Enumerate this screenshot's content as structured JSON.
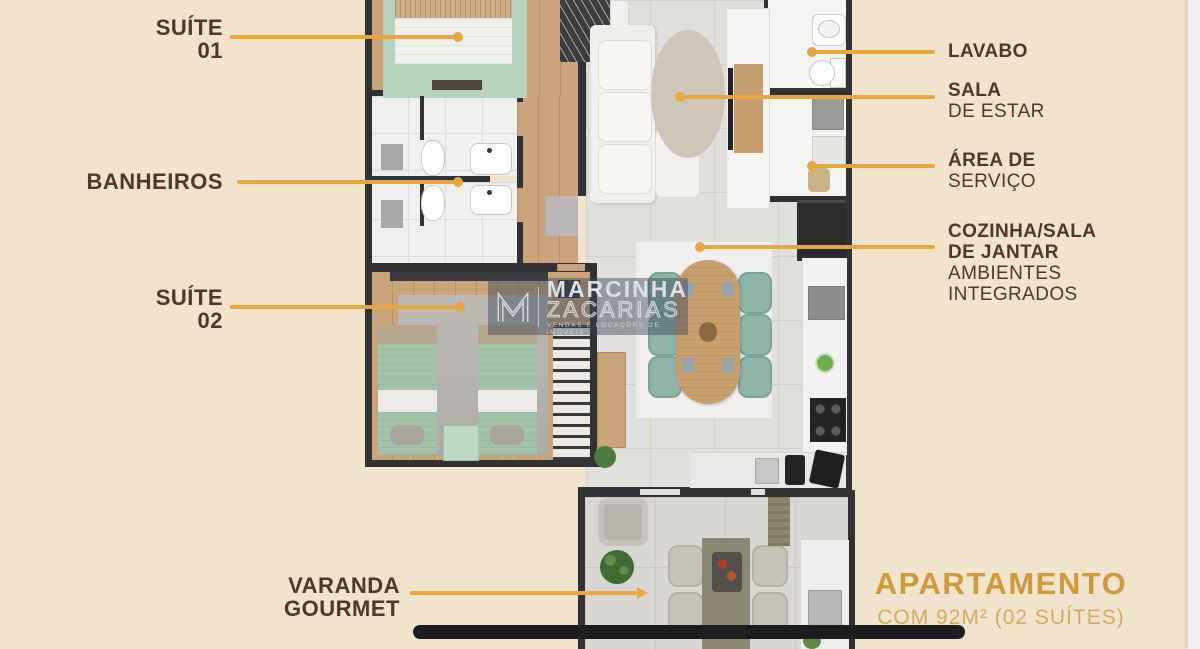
{
  "page": {
    "background": "#f2e3cc",
    "right_edge_strip": "#edeff2"
  },
  "palette": {
    "accent_gold": "#e8a63e",
    "label_brown": "#4c3927",
    "footer_gold": "#cf9a3b",
    "footer_gold_light": "#d4aa5e",
    "bar_black": "#1d1d1f",
    "wall_dark": "#323234",
    "wood_floor": "#c9a47a",
    "tile_gray": "#e0dfdc",
    "bed_green": "#a3c3a8",
    "chair_teal": "#8fb5a9"
  },
  "callouts": {
    "suite01": {
      "title": "SUÍTE",
      "subtitle": "01"
    },
    "banheiros": {
      "title": "BANHEIROS"
    },
    "suite02": {
      "title": "SUÍTE",
      "subtitle": "02"
    },
    "varanda": {
      "title": "VARANDA",
      "subtitle": "GOURMET"
    },
    "lavabo": {
      "title": "LAVABO"
    },
    "sala": {
      "title": "SALA",
      "subtitle": "DE ESTAR"
    },
    "servico": {
      "title": "ÁREA DE",
      "subtitle": "SERVIÇO"
    },
    "cozinha": {
      "title": "COZINHA/SALA",
      "title2": "DE JANTAR",
      "subtitle": "AMBIENTES",
      "subtitle2": "INTEGRADOS"
    }
  },
  "footer": {
    "title": "APARTAMENTO",
    "subtitle": "COM 92M² (02 SUÍTES)"
  },
  "watermark": {
    "monogram": "M",
    "name_line1": "MARCINHA",
    "name_line2": "ZACARIAS",
    "tagline": "VENDAS E LOCAÇÕES DE IMÓVEIS"
  }
}
